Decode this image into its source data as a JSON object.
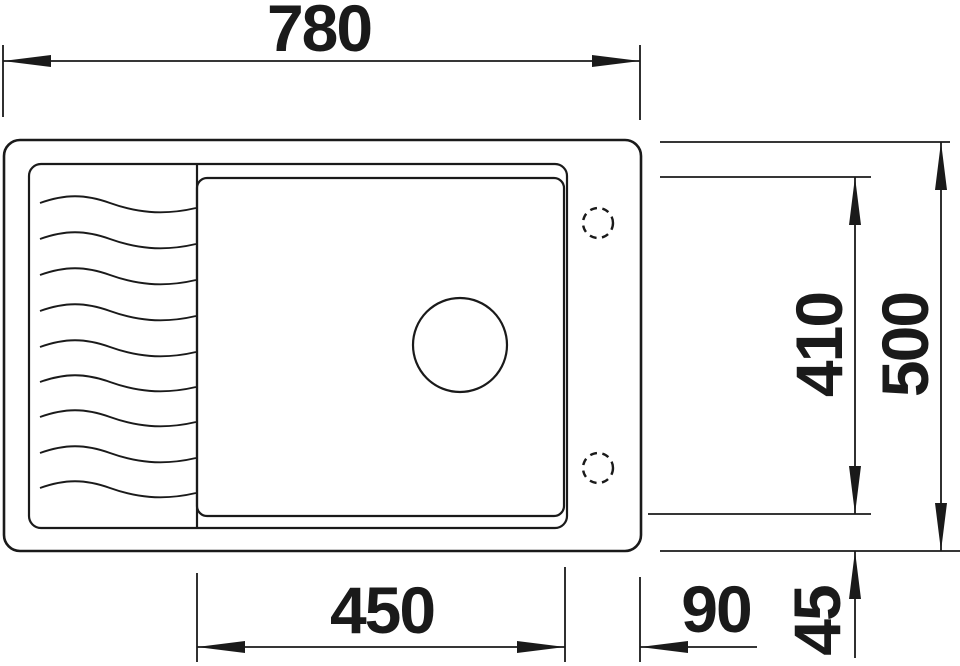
{
  "drawing": {
    "type": "sink-technical-drawing-top-view",
    "background_color": "#ffffff",
    "line_color": "#1a1a1a",
    "dimensions": {
      "overall_width": "780",
      "overall_depth": "500",
      "bowl_depth": "410",
      "bowl_width": "450",
      "right_ledge_width": "90",
      "bottom_inset": "45"
    }
  }
}
